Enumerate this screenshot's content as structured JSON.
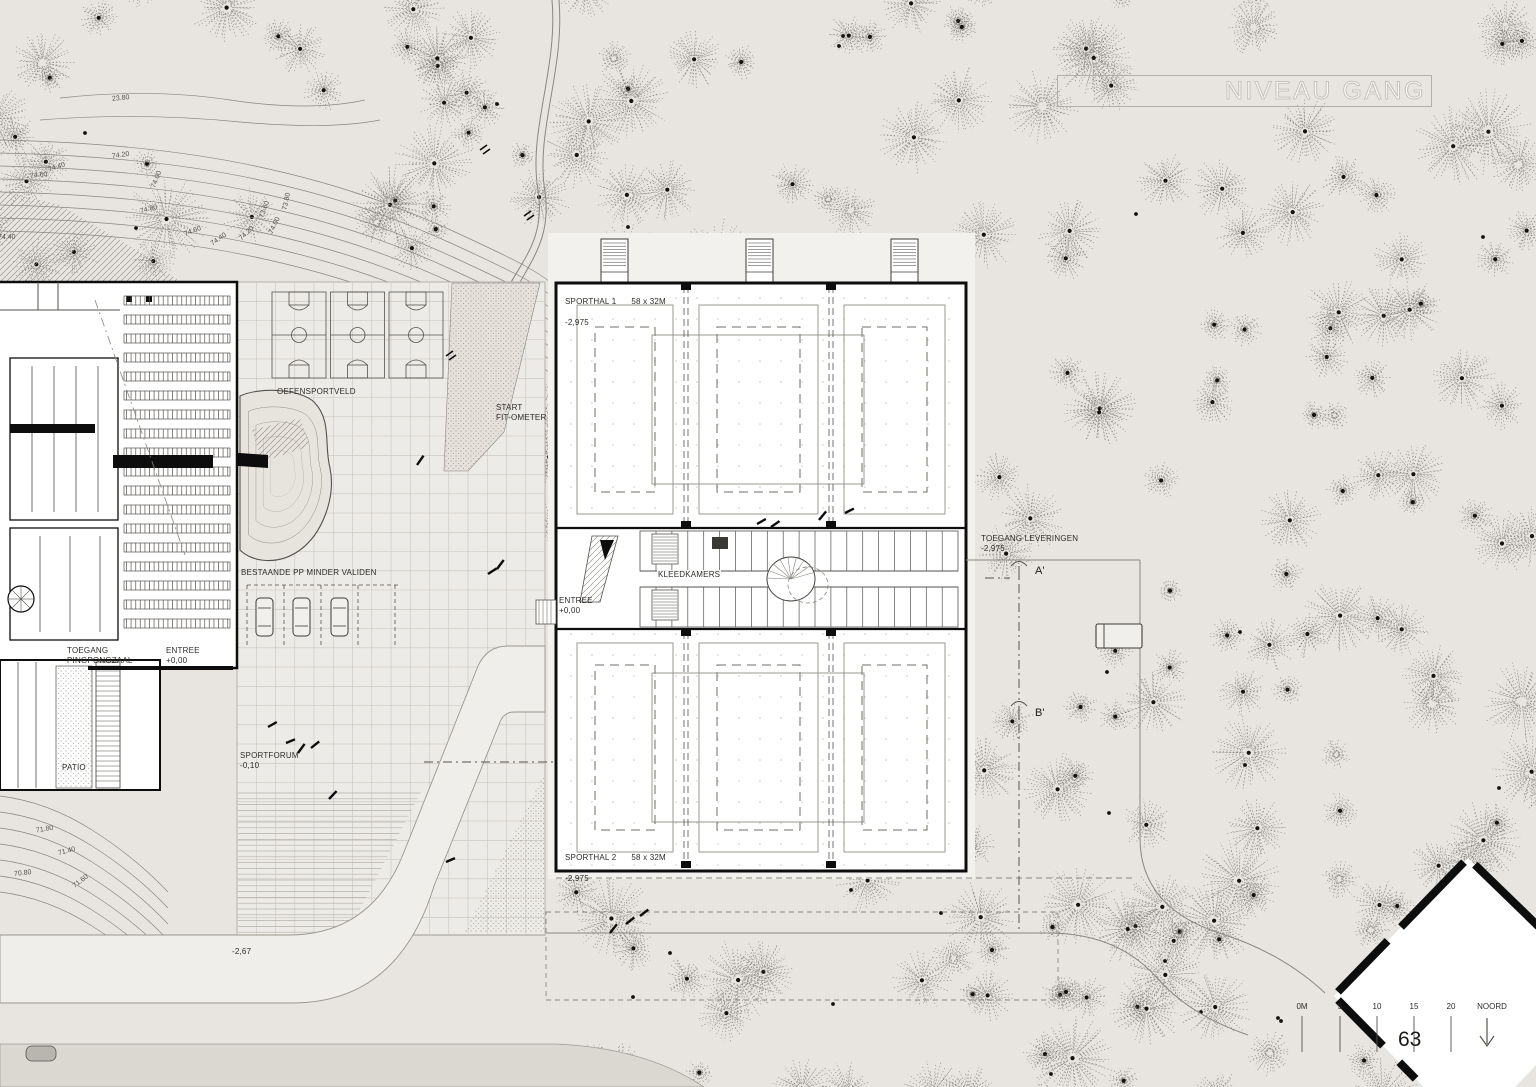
{
  "title": {
    "label": "NIVEAU GANG"
  },
  "page_number": "63",
  "colors": {
    "bg": "#e8e5e1",
    "plaza": "#edebe7",
    "road": "#f0eeea",
    "road_dark": "#dbd7d1",
    "building_fill": "#ffffff",
    "ink": "#0d0d0d",
    "line": "#55524e",
    "faint": "#8a8680",
    "grid": "#c7c4bf",
    "tree": "#6b6760",
    "dot": "#14120f",
    "stipple_bg": "#e5e1da",
    "apron": "#f3f1ed"
  },
  "sporthal1": {
    "name": "SPORTHAL 1",
    "dims": "58 x 32M",
    "level": "-2,975"
  },
  "sporthal2": {
    "name": "SPORTHAL 2",
    "dims": "58 x 32M",
    "level": "-2,975"
  },
  "labels": {
    "kleedkamers": "KLEEDKAMERS",
    "entree_sporthal": "ENTREE\n+0,00",
    "toegang_pingpongzaal": "TOEGANG\nPINGPONGZAAL",
    "entree_pingpong": "ENTREE\n+0,00",
    "oefensportveld": "OEFENSPORTVELD",
    "start_fitometer": "START\nFIT-OMETER",
    "pp_minder_validen": "BESTAANDE PP MINDER VALIDEN",
    "sportforum": "SPORTFORUM\n-0,10",
    "patio": "PATIO",
    "toegang_leveringen": "TOEGANG LEVERINGEN\n-2,975",
    "section_a": "A'",
    "section_b": "B'",
    "level_267": "-2,67"
  },
  "scalebar": {
    "ticks": [
      "0M",
      "5",
      "10",
      "15",
      "20"
    ],
    "north_label": "NOORD"
  },
  "contour_labels": {
    "top_left": [
      {
        "t": "23.80",
        "x": 112,
        "y": 95,
        "r": -6
      },
      {
        "t": "74.20",
        "x": 112,
        "y": 152,
        "r": -8
      },
      {
        "t": "74.00",
        "x": 148,
        "y": 176,
        "r": -68
      },
      {
        "t": "74.60",
        "x": 30,
        "y": 172,
        "r": -6
      },
      {
        "t": "74.40",
        "x": 48,
        "y": 164,
        "r": -18
      },
      {
        "t": "74.40",
        "x": -2,
        "y": 234,
        "r": 0
      },
      {
        "t": "74.80",
        "x": 140,
        "y": 206,
        "r": -14
      },
      {
        "t": "74.60",
        "x": 184,
        "y": 228,
        "r": -22
      },
      {
        "t": "74.40",
        "x": 210,
        "y": 236,
        "r": -35
      },
      {
        "t": "74.20",
        "x": 238,
        "y": 230,
        "r": -44
      },
      {
        "t": "74.00",
        "x": 266,
        "y": 222,
        "r": -64
      },
      {
        "t": "73.80",
        "x": 278,
        "y": 198,
        "r": -78
      },
      {
        "t": "73.60",
        "x": 256,
        "y": 206,
        "r": -70
      }
    ],
    "bottom_left": [
      {
        "t": "71.80",
        "x": 36,
        "y": 826,
        "r": -10
      },
      {
        "t": "71.40",
        "x": 58,
        "y": 848,
        "r": -14
      },
      {
        "t": "70.80",
        "x": 14,
        "y": 870,
        "r": -6
      },
      {
        "t": "71.60",
        "x": 72,
        "y": 878,
        "r": -38
      }
    ]
  }
}
